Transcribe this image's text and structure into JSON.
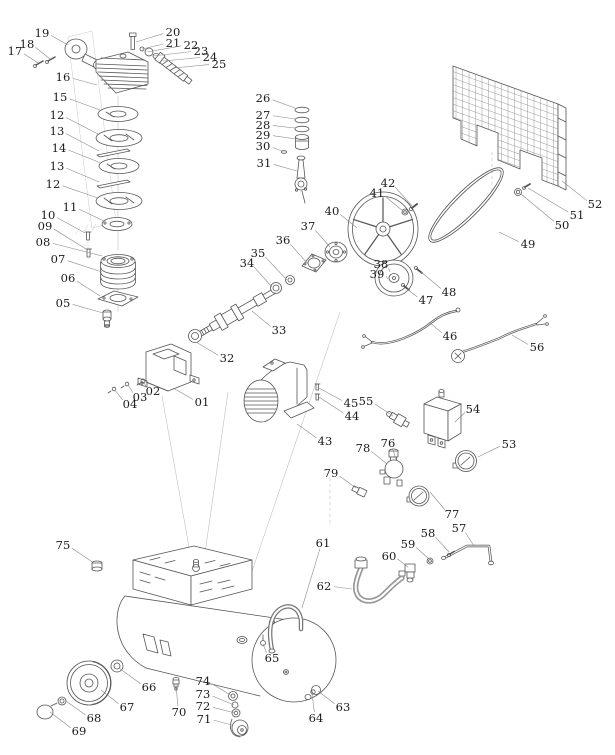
{
  "diagram": {
    "type": "exploded-parts-diagram",
    "subject": "belt-drive air compressor parts breakdown",
    "background_color": "#ffffff",
    "line_color": "#555555",
    "label_color": "#1c1c1c",
    "leader_color": "#8a8a8a",
    "label_font_size": 11.5,
    "labels": [
      {
        "text": "01",
        "x": 202,
        "y": 402,
        "tx": 173,
        "ty": 388
      },
      {
        "text": "02",
        "x": 153,
        "y": 391,
        "tx": 144,
        "ty": 382
      },
      {
        "text": "03",
        "x": 140,
        "y": 397,
        "tx": 128,
        "ty": 385
      },
      {
        "text": "04",
        "x": 130,
        "y": 404,
        "tx": 115,
        "ty": 390
      },
      {
        "text": "05",
        "x": 63,
        "y": 303,
        "tx": 103,
        "ty": 313
      },
      {
        "text": "06",
        "x": 68,
        "y": 278,
        "tx": 100,
        "ty": 296
      },
      {
        "text": "07",
        "x": 58,
        "y": 259,
        "tx": 102,
        "ty": 272
      },
      {
        "text": "08",
        "x": 43,
        "y": 242,
        "tx": 102,
        "ty": 256
      },
      {
        "text": "09",
        "x": 45,
        "y": 226,
        "tx": 86,
        "ty": 249
      },
      {
        "text": "10",
        "x": 48,
        "y": 215,
        "tx": 85,
        "ty": 233
      },
      {
        "text": "11",
        "x": 70,
        "y": 207,
        "tx": 104,
        "ty": 221
      },
      {
        "text": "12",
        "x": 57,
        "y": 115,
        "tx": 98,
        "ty": 134
      },
      {
        "text": "13",
        "x": 57,
        "y": 131,
        "tx": 99,
        "ty": 151
      },
      {
        "text": "14",
        "x": 59,
        "y": 148,
        "tx": 101,
        "ty": 163
      },
      {
        "text": "13",
        "x": 57,
        "y": 166,
        "tx": 99,
        "ty": 182
      },
      {
        "text": "12",
        "x": 53,
        "y": 184,
        "tx": 98,
        "ty": 198
      },
      {
        "text": "15",
        "x": 60,
        "y": 97,
        "tx": 100,
        "ty": 110
      },
      {
        "text": "16",
        "x": 63,
        "y": 77,
        "tx": 97,
        "ty": 85
      },
      {
        "text": "17",
        "x": 15,
        "y": 51,
        "tx": 38,
        "ty": 63
      },
      {
        "text": "18",
        "x": 27,
        "y": 44,
        "tx": 50,
        "ty": 59
      },
      {
        "text": "19",
        "x": 42,
        "y": 33,
        "tx": 68,
        "ty": 45
      },
      {
        "text": "20",
        "x": 173,
        "y": 32,
        "tx": 136,
        "ty": 42
      },
      {
        "text": "21",
        "x": 173,
        "y": 43,
        "tx": 142,
        "ty": 49
      },
      {
        "text": "22",
        "x": 191,
        "y": 45,
        "tx": 147,
        "ty": 52
      },
      {
        "text": "23",
        "x": 201,
        "y": 51,
        "tx": 153,
        "ty": 56
      },
      {
        "text": "24",
        "x": 210,
        "y": 57,
        "tx": 163,
        "ty": 61
      },
      {
        "text": "25",
        "x": 219,
        "y": 64,
        "tx": 174,
        "ty": 68
      },
      {
        "text": "26",
        "x": 263,
        "y": 98,
        "tx": 295,
        "ty": 108
      },
      {
        "text": "27",
        "x": 263,
        "y": 115,
        "tx": 295,
        "ty": 119
      },
      {
        "text": "28",
        "x": 263,
        "y": 125,
        "tx": 295,
        "ty": 128
      },
      {
        "text": "29",
        "x": 263,
        "y": 135,
        "tx": 296,
        "ty": 139
      },
      {
        "text": "30",
        "x": 263,
        "y": 146,
        "tx": 282,
        "ty": 151
      },
      {
        "text": "31",
        "x": 264,
        "y": 163,
        "tx": 297,
        "ty": 171
      },
      {
        "text": "32",
        "x": 227,
        "y": 358,
        "tx": 196,
        "ty": 342
      },
      {
        "text": "33",
        "x": 279,
        "y": 330,
        "tx": 252,
        "ty": 311
      },
      {
        "text": "34",
        "x": 247,
        "y": 263,
        "tx": 272,
        "ty": 287
      },
      {
        "text": "35",
        "x": 258,
        "y": 253,
        "tx": 287,
        "ty": 280
      },
      {
        "text": "36",
        "x": 283,
        "y": 240,
        "tx": 309,
        "ty": 265
      },
      {
        "text": "37",
        "x": 308,
        "y": 226,
        "tx": 330,
        "ty": 247
      },
      {
        "text": "38",
        "x": 381,
        "y": 264,
        "tx": 390,
        "ty": 272
      },
      {
        "text": "39",
        "x": 377,
        "y": 274,
        "tx": 388,
        "ty": 279
      },
      {
        "text": "40",
        "x": 332,
        "y": 211,
        "tx": 357,
        "ty": 228
      },
      {
        "text": "41",
        "x": 377,
        "y": 193,
        "tx": 403,
        "ty": 211
      },
      {
        "text": "42",
        "x": 388,
        "y": 183,
        "tx": 412,
        "ty": 206
      },
      {
        "text": "43",
        "x": 325,
        "y": 441,
        "tx": 297,
        "ty": 424
      },
      {
        "text": "44",
        "x": 352,
        "y": 416,
        "tx": 319,
        "ty": 397
      },
      {
        "text": "45",
        "x": 351,
        "y": 403,
        "tx": 319,
        "ty": 388
      },
      {
        "text": "46",
        "x": 450,
        "y": 336,
        "tx": 429,
        "ty": 322
      },
      {
        "text": "47",
        "x": 426,
        "y": 300,
        "tx": 407,
        "ty": 289
      },
      {
        "text": "48",
        "x": 449,
        "y": 292,
        "tx": 421,
        "ty": 272
      },
      {
        "text": "49",
        "x": 528,
        "y": 244,
        "tx": 499,
        "ty": 232
      },
      {
        "text": "50",
        "x": 562,
        "y": 225,
        "tx": 521,
        "ty": 194
      },
      {
        "text": "51",
        "x": 577,
        "y": 215,
        "tx": 528,
        "ty": 188
      },
      {
        "text": "52",
        "x": 595,
        "y": 204,
        "tx": 562,
        "ty": 181
      },
      {
        "text": "53",
        "x": 509,
        "y": 444,
        "tx": 478,
        "ty": 457
      },
      {
        "text": "54",
        "x": 473,
        "y": 409,
        "tx": 455,
        "ty": 422
      },
      {
        "text": "55",
        "x": 366,
        "y": 401,
        "tx": 393,
        "ty": 416
      },
      {
        "text": "56",
        "x": 537,
        "y": 347,
        "tx": 512,
        "ty": 335
      },
      {
        "text": "57",
        "x": 459,
        "y": 528,
        "tx": 474,
        "ty": 546
      },
      {
        "text": "58",
        "x": 428,
        "y": 533,
        "tx": 449,
        "ty": 552
      },
      {
        "text": "59",
        "x": 408,
        "y": 544,
        "tx": 429,
        "ty": 559
      },
      {
        "text": "60",
        "x": 389,
        "y": 556,
        "tx": 408,
        "ty": 567
      },
      {
        "text": "61",
        "x": 323,
        "y": 543,
        "tx": 302,
        "ty": 608
      },
      {
        "text": "62",
        "x": 324,
        "y": 586,
        "tx": 352,
        "ty": 589
      },
      {
        "text": "63",
        "x": 343,
        "y": 707,
        "tx": 318,
        "ty": 691
      },
      {
        "text": "64",
        "x": 316,
        "y": 718,
        "tx": 312,
        "ty": 694
      },
      {
        "text": "65",
        "x": 272,
        "y": 658,
        "tx": 263,
        "ty": 644
      },
      {
        "text": "66",
        "x": 149,
        "y": 687,
        "tx": 119,
        "ty": 668
      },
      {
        "text": "67",
        "x": 127,
        "y": 707,
        "tx": 101,
        "ty": 690
      },
      {
        "text": "68",
        "x": 94,
        "y": 718,
        "tx": 66,
        "ty": 701
      },
      {
        "text": "69",
        "x": 79,
        "y": 731,
        "tx": 50,
        "ty": 712
      },
      {
        "text": "70",
        "x": 179,
        "y": 712,
        "tx": 176,
        "ty": 685
      },
      {
        "text": "71",
        "x": 204,
        "y": 719,
        "tx": 232,
        "ty": 725
      },
      {
        "text": "72",
        "x": 203,
        "y": 706,
        "tx": 235,
        "ty": 713
      },
      {
        "text": "73",
        "x": 203,
        "y": 694,
        "tx": 234,
        "ty": 705
      },
      {
        "text": "74",
        "x": 203,
        "y": 681,
        "tx": 232,
        "ty": 696
      },
      {
        "text": "75",
        "x": 63,
        "y": 545,
        "tx": 94,
        "ty": 563
      },
      {
        "text": "76",
        "x": 388,
        "y": 443,
        "tx": 396,
        "ty": 459
      },
      {
        "text": "77",
        "x": 452,
        "y": 514,
        "tx": 430,
        "ty": 492
      },
      {
        "text": "78",
        "x": 363,
        "y": 448,
        "tx": 387,
        "ty": 464
      },
      {
        "text": "79",
        "x": 331,
        "y": 473,
        "tx": 356,
        "ty": 488
      }
    ]
  }
}
